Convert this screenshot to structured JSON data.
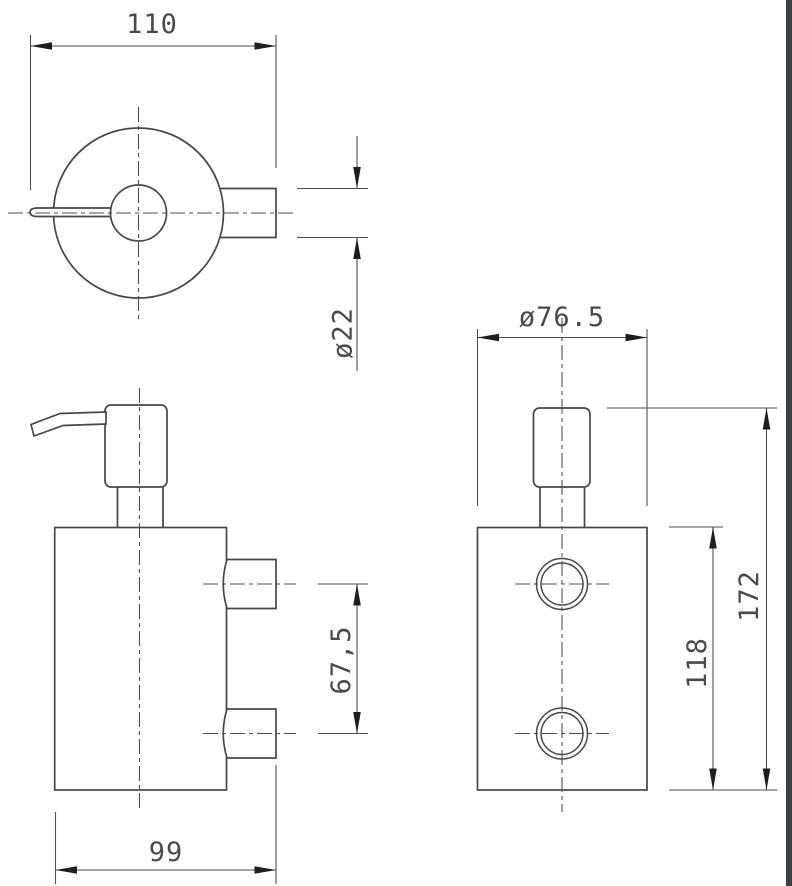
{
  "drawing": {
    "dims": {
      "d110": {
        "label": "110"
      },
      "d22": {
        "label": "ø22"
      },
      "d765": {
        "label": "ø76.5"
      },
      "d675": {
        "label": "67,5"
      },
      "d99": {
        "label": "99"
      },
      "d118": {
        "label": "118"
      },
      "d172": {
        "label": "172"
      }
    },
    "colors": {
      "background": "#ffffff",
      "line": "#474747",
      "thin_line": "#4f4f4f",
      "arrow": "#1e1e1e",
      "text": "#4a4a4a",
      "border_bar": "#3a3f44"
    }
  }
}
